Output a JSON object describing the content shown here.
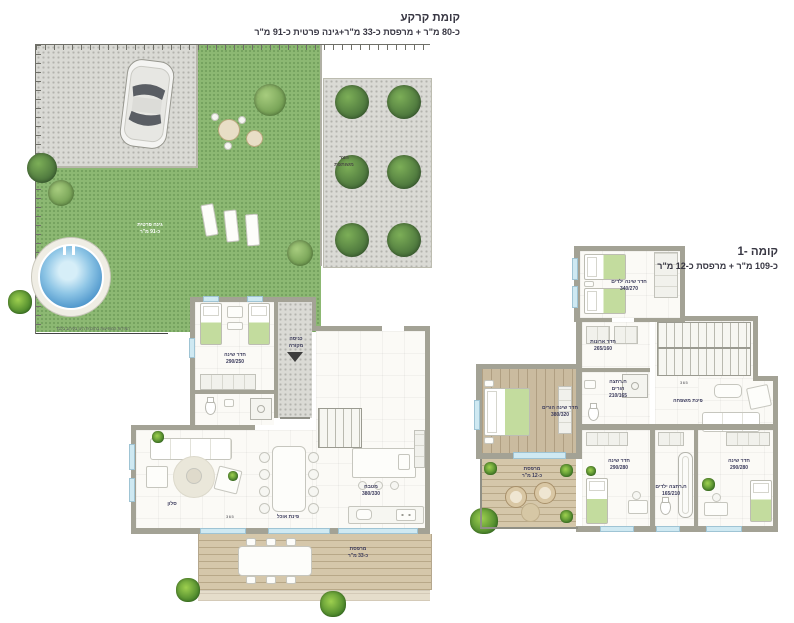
{
  "colors": {
    "wall": "#a3a295",
    "grass": "#8cb873",
    "paver": "#dadad5",
    "deck_wood": "#d5c7aa",
    "floor_wood": "#cabb9f",
    "pool_water": "#4f97cc",
    "window": "#cfe9f2",
    "label_text": "#3b3b5c",
    "title_text": "#383743"
  },
  "ground": {
    "title1": "קומת קרקע",
    "title2": "כ-80 מ\"ר + מרפסת כ-33 מ\"ר+גינה פרטית כ-91 מ\"ר",
    "labels": {
      "bedroom": {
        "l1": "חדר שינה",
        "l2": "290/250"
      },
      "entrance": {
        "l1": "כניסה",
        "l2": "מקורה"
      },
      "living": {
        "l1": "סלון"
      },
      "dining": {
        "l1": "פינת אוכל"
      },
      "kitchen": {
        "l1": "מטבח",
        "l2": "380/330"
      },
      "terrace": {
        "l1": "מרפסת",
        "l2": "כ-33 מ\"ר"
      },
      "garden": {
        "l1": "גינה פרטית",
        "l2": "כ-91 מ\"ר"
      },
      "courtyard": {
        "l1": "חצר",
        "l2": "משותפת"
      },
      "dim": "365",
      "note": "המידות המופיעות בתוכנית הינן בקירוב בלבד"
    }
  },
  "first": {
    "title1": "קומה -1",
    "title2": "כ-109 מ\"ר + מרפסת כ-12 מ\"ר",
    "labels": {
      "kids_bedroom": {
        "l1": "חדר שינה ילדים",
        "l2": "340/270"
      },
      "closet": {
        "l1": "חדר ארונות",
        "l2": "265/160"
      },
      "parents_bath": {
        "l1": "ח.רחצה",
        "l2": "הורים",
        "l3": "210/165"
      },
      "master_bedroom": {
        "l1": "חדר שינה הורים",
        "l2": "380/320"
      },
      "balcony": {
        "l1": "מרפסת",
        "l2": "כ-12 מ\"ר"
      },
      "bedroom2": {
        "l1": "חדר שינה",
        "l2": "290/280"
      },
      "kids_bath": {
        "l1": "ח.רחצה ילדים",
        "l2": "165/210"
      },
      "bedroom3": {
        "l1": "חדר שינה",
        "l2": "290/280"
      },
      "family": {
        "l1": "פינת משפחה"
      },
      "dim": "365"
    }
  }
}
